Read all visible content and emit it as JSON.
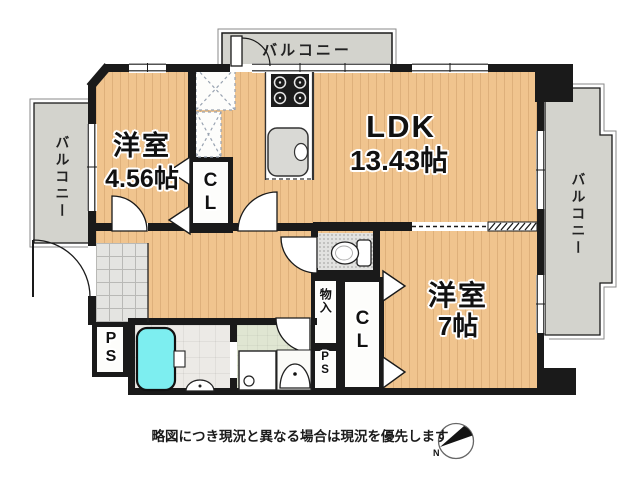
{
  "rooms": {
    "bedroom1": {
      "name": "洋室",
      "size": "4.56帖"
    },
    "ldk": {
      "name": "LDK",
      "size": "13.43帖"
    },
    "bedroom2": {
      "name": "洋室",
      "size": "7帖"
    },
    "closet1": {
      "label": "CL"
    },
    "closet2": {
      "label": "CL"
    },
    "storage": {
      "label": "物入"
    },
    "ps1": {
      "label": "PS"
    },
    "ps2": {
      "label": "PS"
    }
  },
  "balconies": {
    "top": {
      "label": "バルコニー"
    },
    "left": {
      "label": "バルコニー"
    },
    "right": {
      "label": "バルコニー"
    }
  },
  "footer": {
    "disclaimer": "略図につき現況と異なる場合は現況を優先します"
  },
  "compass": {
    "label": "N"
  },
  "colors": {
    "wall": "#1a1a1a",
    "wood_floor": "#f0c48e",
    "balcony": "#d3d3cd",
    "bathtub": "#7deef0",
    "washroom_floor": "#e0e6d2",
    "entrance_tile": "#e4e4e1",
    "bath_floor": "#eceae6",
    "toilet_floor": "#e2e2e0",
    "kitchen_counter": "#ffffff"
  }
}
